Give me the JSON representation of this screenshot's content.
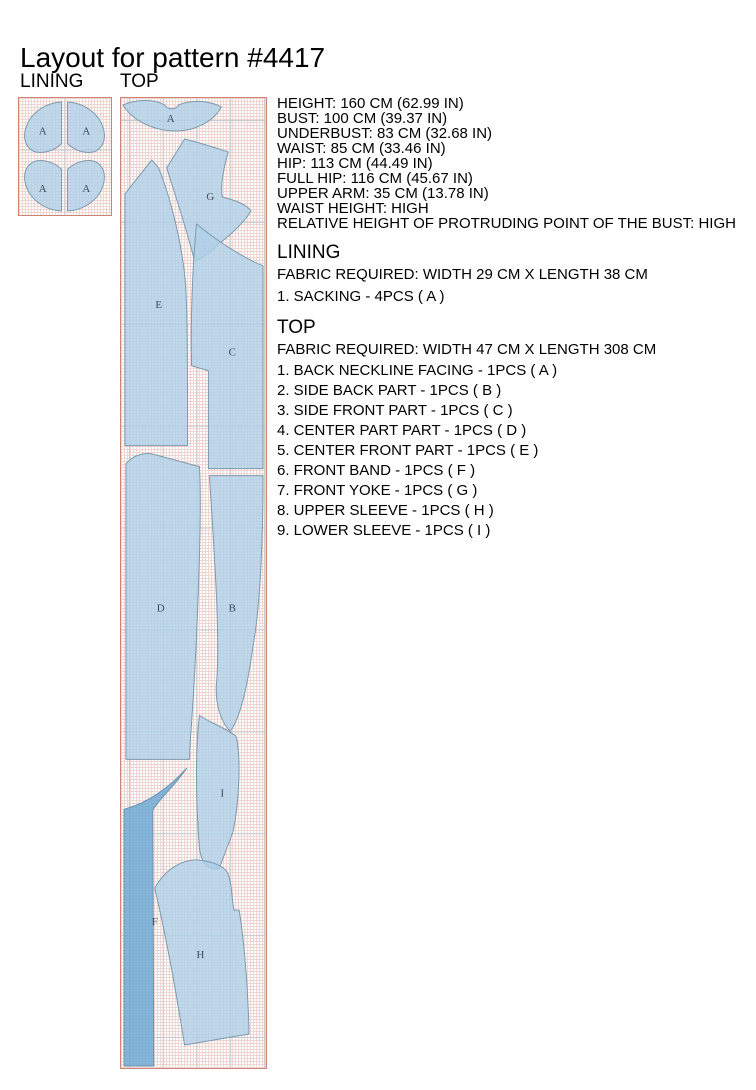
{
  "page": {
    "title": "Layout for pattern #4417"
  },
  "measurements": {
    "lines": [
      "HEIGHT: 160 CM (62.99 IN)",
      "BUST: 100 CM (39.37 IN)",
      "UNDERBUST: 83 CM (32.68 IN)",
      "WAIST: 85 CM (33.46 IN)",
      "HIP: 113 CM (44.49 IN)",
      "FULL HIP: 116 CM (45.67 IN)",
      "UPPER ARM: 35 CM (13.78 IN)",
      "WAIST HEIGHT: HIGH",
      "RELATIVE HEIGHT OF PROTRUDING POINT OF THE BUST: HIGH"
    ]
  },
  "lining": {
    "label": "LINING",
    "heading": "LINING",
    "fabric_required": "FABRIC REQUIRED: WIDTH 29 CM X LENGTH 38 CM",
    "pieces": [
      "1. SACKING - 4PCS ( A )"
    ],
    "piece_labels": [
      "A",
      "A",
      "A",
      "A"
    ]
  },
  "top": {
    "label": "TOP",
    "heading": "TOP",
    "fabric_required": "FABRIC REQUIRED: WIDTH 47 CM X LENGTH 308 CM",
    "pieces": [
      "1. BACK NECKLINE FACING - 1PCS ( A )",
      "2. SIDE BACK PART - 1PCS ( B )",
      "3. SIDE FRONT PART - 1PCS ( C )",
      "4. CENTER PART PART - 1PCS ( D )",
      "5. CENTER FRONT PART - 1PCS ( E )",
      "6. FRONT BAND - 1PCS ( F )",
      "7. FRONT YOKE - 1PCS ( G )",
      "8. UPPER SLEEVE - 1PCS ( H )",
      "9. LOWER SLEEVE - 1PCS ( I )"
    ],
    "piece_labels": [
      "A",
      "G",
      "E",
      "C",
      "D",
      "B",
      "I",
      "F",
      "H"
    ]
  },
  "colors": {
    "piece_fill": "#aed0e8",
    "piece_fill_dark": "#6fa9d2",
    "piece_stroke": "#7e99ac",
    "sheet_border": "#d08274",
    "grid_minor": "#eed6d3",
    "grid_major": "#c6cbcf"
  }
}
